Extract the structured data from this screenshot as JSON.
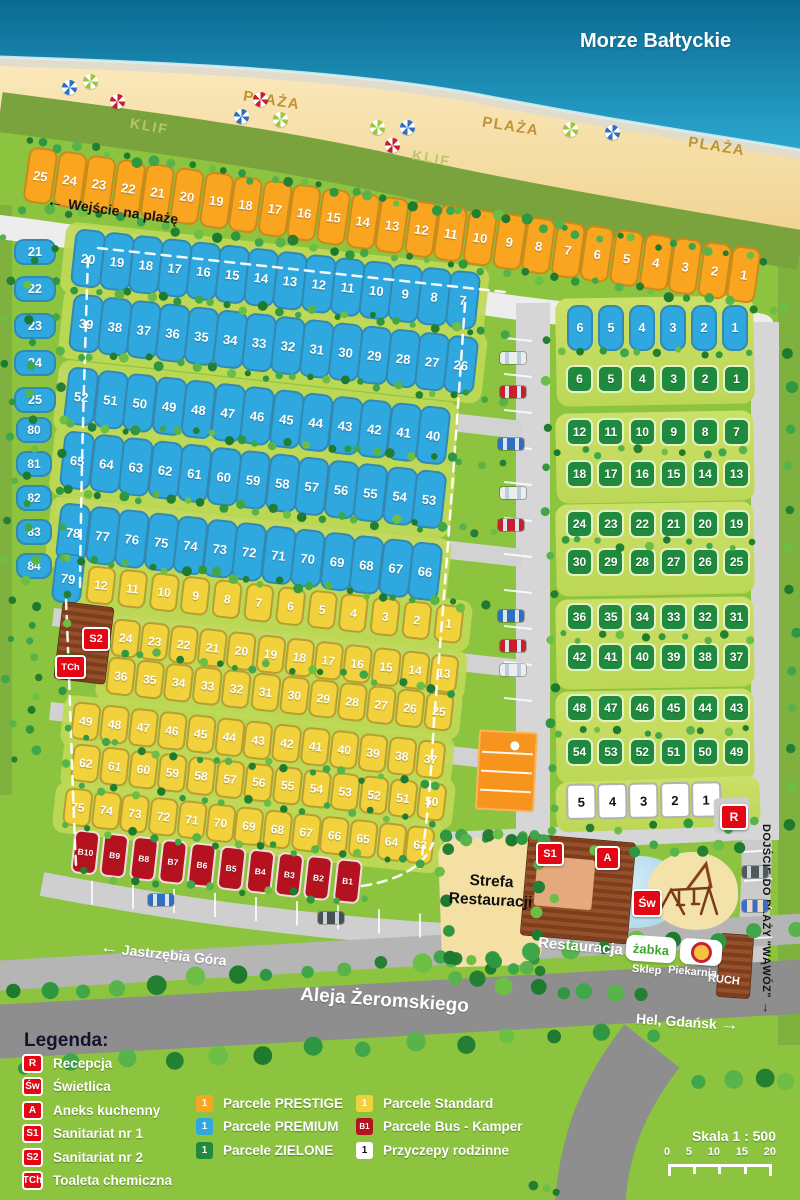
{
  "labels": {
    "sea": "Morze Bałtyckie",
    "beach": "PLAŻA",
    "cliff": "KLIF",
    "beach_entrance": "Wejście na plażę",
    "main_road": "Aleja Żeromskiego",
    "west": "Jastrzębia Góra",
    "east": "Hel, Gdańsk",
    "gorge": "DOJŚCIE DO PLAŻY \"WĄWÓZ\"",
    "zone_line1": "Strefa",
    "zone_line2": "Restauracji",
    "restaurant": "Restauracja",
    "shop_logo": "żabka",
    "shop": "Sklep",
    "bakery": "Piekarnia",
    "kiosk": "RUCH"
  },
  "icons": {
    "left": "←",
    "right": "→",
    "down": "↓"
  },
  "badges": {
    "r": "R",
    "sw": "Św",
    "a": "A",
    "s1": "S1",
    "s2": "S2",
    "tch": "TCh"
  },
  "plots": {
    "prestige": [
      "25",
      "24",
      "23",
      "22",
      "21",
      "20",
      "19",
      "18",
      "17",
      "16",
      "15",
      "14",
      "13",
      "12",
      "11",
      "10",
      "9",
      "8",
      "7",
      "6",
      "5",
      "4",
      "3",
      "2",
      "1"
    ],
    "left_a": [
      "21",
      "22",
      "23",
      "24",
      "25"
    ],
    "left_b": [
      "80",
      "81",
      "82",
      "83",
      "84"
    ],
    "p1": [
      "20",
      "19",
      "18",
      "17",
      "16",
      "15",
      "14",
      "13",
      "12",
      "11",
      "10",
      "9",
      "8",
      "7"
    ],
    "p2": [
      "39",
      "38",
      "37",
      "36",
      "35",
      "34",
      "33",
      "32",
      "31",
      "30",
      "29",
      "28",
      "27",
      "26"
    ],
    "p3": [
      "52",
      "51",
      "50",
      "49",
      "48",
      "47",
      "46",
      "45",
      "44",
      "43",
      "42",
      "41",
      "40"
    ],
    "p4": [
      "65",
      "64",
      "63",
      "62",
      "61",
      "60",
      "59",
      "58",
      "57",
      "56",
      "55",
      "54",
      "53"
    ],
    "p5": [
      "78",
      "77",
      "76",
      "75",
      "74",
      "73",
      "72",
      "71",
      "70",
      "69",
      "68",
      "67",
      "66"
    ],
    "p79": [
      "79"
    ],
    "pr": [
      "6",
      "5",
      "4",
      "3",
      "2",
      "1"
    ],
    "g1": [
      "6",
      "5",
      "4",
      "3",
      "2",
      "1"
    ],
    "g2a": [
      "12",
      "11",
      "10",
      "9",
      "8",
      "7"
    ],
    "g2b": [
      "18",
      "17",
      "16",
      "15",
      "14",
      "13"
    ],
    "g3a": [
      "24",
      "23",
      "22",
      "21",
      "20",
      "19"
    ],
    "g3b": [
      "30",
      "29",
      "28",
      "27",
      "26",
      "25"
    ],
    "g4a": [
      "36",
      "35",
      "34",
      "33",
      "32",
      "31"
    ],
    "g4b": [
      "42",
      "41",
      "40",
      "39",
      "38",
      "37"
    ],
    "g5a": [
      "48",
      "47",
      "46",
      "45",
      "44",
      "43"
    ],
    "g5b": [
      "54",
      "53",
      "52",
      "51",
      "50",
      "49"
    ],
    "wrow": [
      "5",
      "4",
      "3",
      "2",
      "1"
    ],
    "y1": [
      "12",
      "11",
      "10",
      "9",
      "8",
      "7",
      "6",
      "5",
      "4",
      "3",
      "2",
      "1"
    ],
    "y2": [
      "24",
      "23",
      "22",
      "21",
      "20",
      "19",
      "18",
      "17",
      "16",
      "15",
      "14",
      "13"
    ],
    "y3": [
      "36",
      "35",
      "34",
      "33",
      "32",
      "31",
      "30",
      "29",
      "28",
      "27",
      "26",
      "25"
    ],
    "y4": [
      "49",
      "48",
      "47",
      "46",
      "45",
      "44",
      "43",
      "42",
      "41",
      "40",
      "39",
      "38",
      "37"
    ],
    "y5": [
      "62",
      "61",
      "60",
      "59",
      "58",
      "57",
      "56",
      "55",
      "54",
      "53",
      "52",
      "51",
      "50"
    ],
    "y6": [
      "75",
      "74",
      "73",
      "72",
      "71",
      "70",
      "69",
      "68",
      "67",
      "66",
      "65",
      "64",
      "63"
    ],
    "bus": [
      "B10",
      "B9",
      "B8",
      "B7",
      "B6",
      "B5",
      "B4",
      "B3",
      "B2",
      "B1"
    ]
  },
  "legend": {
    "title": "Legenda:",
    "facilities": [
      {
        "code": "R",
        "label": "Recepcja"
      },
      {
        "code": "Św",
        "label": "Świetlica"
      },
      {
        "code": "A",
        "label": "Aneks kuchenny"
      },
      {
        "code": "S1",
        "label": "Sanitariat nr 1"
      },
      {
        "code": "S2",
        "label": "Sanitariat nr 2"
      },
      {
        "code": "TCh",
        "label": "Toaleta chemiczna"
      }
    ],
    "parcels_left": [
      {
        "code": "1",
        "type": "prestige",
        "label": "Parcele PRESTIGE"
      },
      {
        "code": "1",
        "type": "premium",
        "label": "Parcele PREMIUM"
      },
      {
        "code": "1",
        "type": "zielone",
        "label": "Parcele ZIELONE"
      }
    ],
    "parcels_right": [
      {
        "code": "1",
        "type": "standard",
        "label": "Parcele Standard"
      },
      {
        "code": "B1",
        "type": "bus",
        "label": "Parcele Bus - Kamper"
      },
      {
        "code": "1",
        "type": "white",
        "label": "Przyczepy rodzinne"
      }
    ]
  },
  "scale": {
    "label": "Skala 1 : 500",
    "ticks": [
      "0",
      "5",
      "10",
      "15",
      "20"
    ]
  },
  "colors": {
    "prestige": "#F9A51F",
    "premium": "#2FA8DF",
    "zielone": "#1F8A3D",
    "standard": "#F2D23C",
    "bus": "#B5121F",
    "badge": "#E30613",
    "sea": "#1491BC",
    "sand": "#F6DDA0",
    "grass": "#8CC43F"
  }
}
